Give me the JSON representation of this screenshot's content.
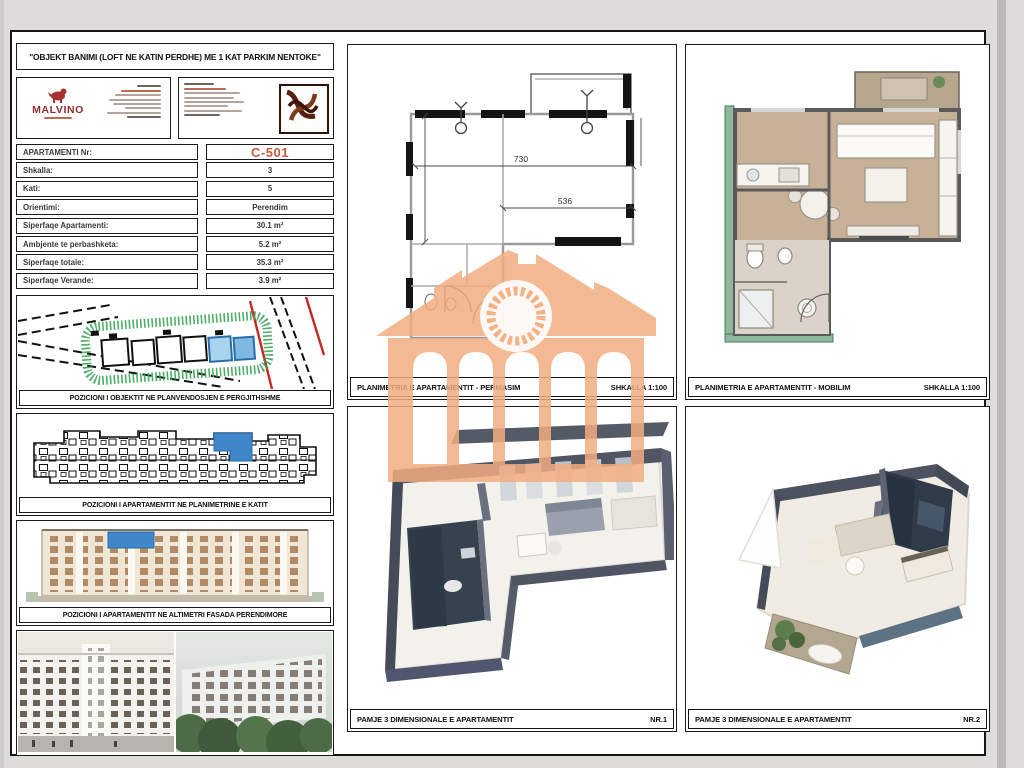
{
  "sheet": {
    "title": "\"OBJEKT BANIMI (LOFT NE KATIN PERDHE) ME 1 KAT PARKIM NENTOKE\""
  },
  "brand": {
    "name": "MALVINO"
  },
  "apartment_table": {
    "rows": [
      {
        "label": "APARTAMENTI Nr:",
        "value": "C-501"
      },
      {
        "label": "Shkalla:",
        "value": "3"
      },
      {
        "label": "Kati:",
        "value": "5"
      },
      {
        "label": "Orientimi:",
        "value": "Perendim"
      },
      {
        "label": "Siperfaqe Apartamenti:",
        "value": "30.1 m²"
      },
      {
        "label": "Ambjente te perbashketa:",
        "value": "5.2 m²"
      },
      {
        "label": "Siperfaqe totale:",
        "value": "35.3 m²"
      },
      {
        "label": "Siperfaqe Verande:",
        "value": "3.9 m²"
      }
    ],
    "highlight_value_color": "#c75b42"
  },
  "panels": {
    "site_position_caption": "POZICIONI I OBJEKTIT NE PLANVENDOSJEN E PERGJITHSHME",
    "floor_position_caption": "POZICIONI I APARTAMENTIT  NE PLANIMETRINE E KATIT",
    "elevation_caption": "POZICIONI I APARTAMENTIT NE ALTIMETRI  FASADA PERENDIMORE",
    "plan_dimensioned": {
      "caption": "PLANIMETRIA E APARTAMENTIT - PERMASIM",
      "scale": "SHKALLA 1:100"
    },
    "plan_furnished": {
      "caption": "PLANIMETRIA E APARTAMENTIT - MOBILIM",
      "scale": "SHKALLA 1:100"
    },
    "view3d_1": {
      "caption": "PAMJE 3 DIMENSIONALE E APARTAMENTIT",
      "number": "NR.1"
    },
    "view3d_2": {
      "caption": "PAMJE 3 DIMENSIONALE E APARTAMENTIT",
      "number": "NR.2"
    }
  },
  "plan_dimensions": {
    "width_top": "730",
    "width_mid": "536"
  },
  "colors": {
    "highlight_blue": "#3f87c9",
    "watermark_orange": "#f1ad80",
    "site_green": "#3ba457",
    "site_red": "#c52a22",
    "apartment_number": "#c75b42"
  }
}
